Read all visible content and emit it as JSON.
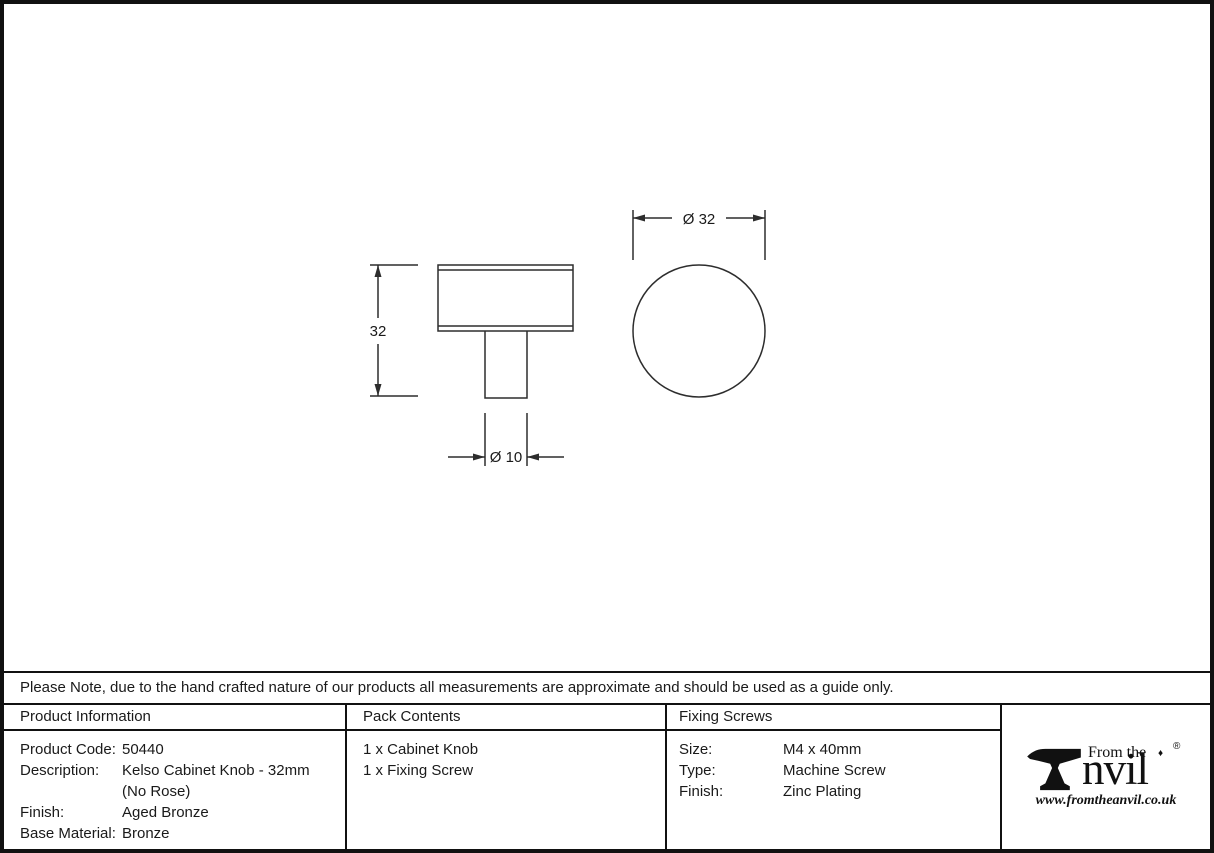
{
  "dimensions": {
    "side_height": "32",
    "shaft_diameter": "Ø 10",
    "knob_diameter": "Ø 32"
  },
  "note": "Please Note, due to the hand crafted nature of our products all measurements are approximate and should be used as a guide only.",
  "product_information": {
    "header": "Product Information",
    "rows": [
      {
        "label": "Product Code:",
        "value": "50440"
      },
      {
        "label": "Description:",
        "value": "Kelso Cabinet Knob - 32mm\n(No Rose)"
      },
      {
        "label": "Finish:",
        "value": "Aged Bronze"
      },
      {
        "label": "Base Material:",
        "value": "Bronze"
      }
    ]
  },
  "pack_contents": {
    "header": "Pack Contents",
    "items": [
      "1 x Cabinet Knob",
      "1 x Fixing Screw"
    ]
  },
  "fixing_screws": {
    "header": "Fixing Screws",
    "rows": [
      {
        "label": "Size:",
        "value": "M4 x 40mm"
      },
      {
        "label": "Type:",
        "value": "Machine Screw"
      },
      {
        "label": "Finish:",
        "value": "Zinc Plating"
      }
    ]
  },
  "logo": {
    "from_the": "From the",
    "word_suffix": "nvil",
    "diamond": "♦",
    "registered": "®",
    "website": "www.fromtheanvil.co.uk"
  },
  "colors": {
    "line": "#2d2d2d",
    "text": "#1a1a1a",
    "border": "#111111"
  }
}
